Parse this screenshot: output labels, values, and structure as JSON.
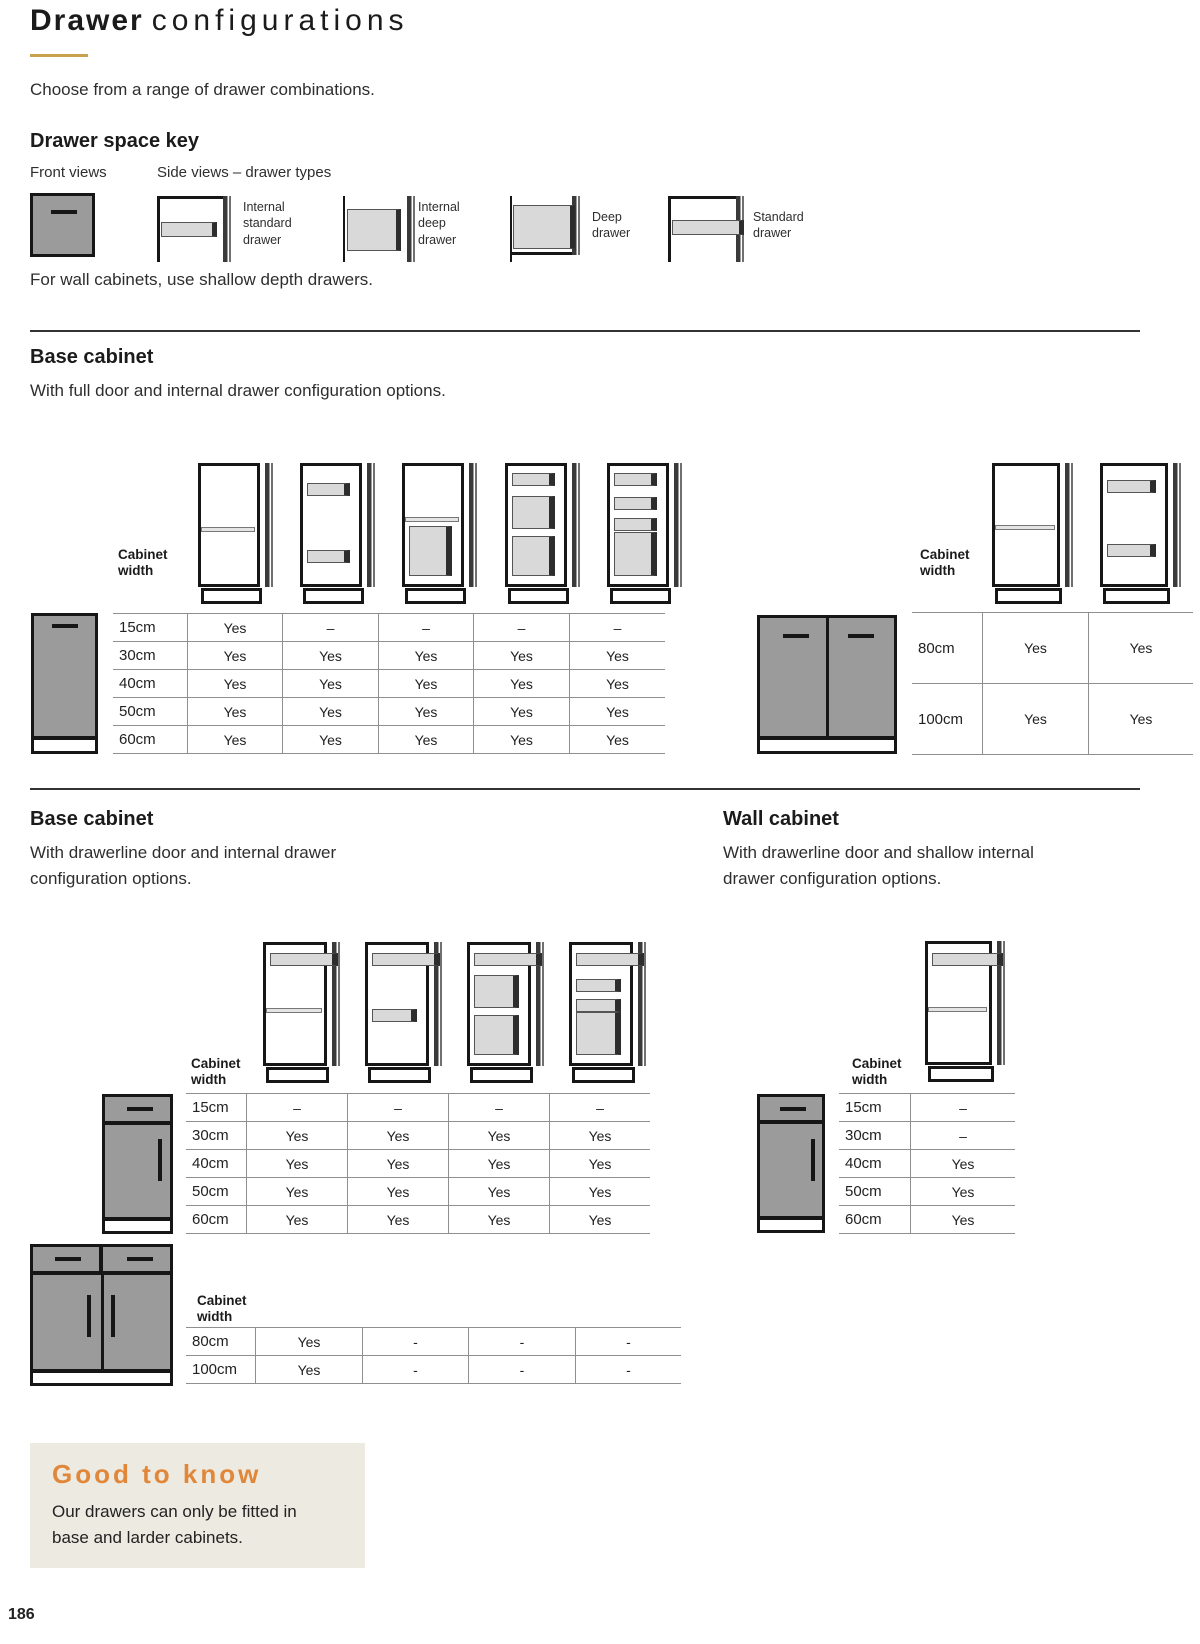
{
  "page_number": "186",
  "colors": {
    "accent_gold": "#c9a24f",
    "accent_orange": "#e0873a",
    "note_background": "#edeae1",
    "cabinet_gray": "#9b9b9b",
    "drawer_gray": "#d9d9d9"
  },
  "header": {
    "title_bold": "Drawer",
    "title_light": "configurations",
    "subtitle": "Choose from a range of drawer combinations."
  },
  "key": {
    "heading": "Drawer space key",
    "front_views_label": "Front views",
    "side_views_label": "Side views – drawer types",
    "types": [
      "Internal\nstandard\ndrawer",
      "Internal\ndeep\ndrawer",
      "Deep\ndrawer",
      "Standard\ndrawer"
    ],
    "note": "For wall cabinets, use shallow depth drawers."
  },
  "cabinet_width_label": "Cabinet\nwidth",
  "section_full_door": {
    "heading": "Base cabinet",
    "subheading": "With full door and internal drawer configuration options.",
    "table": {
      "rows": [
        {
          "label": "15cm",
          "values": [
            "Yes",
            "–",
            "–",
            "–",
            "–"
          ]
        },
        {
          "label": "30cm",
          "values": [
            "Yes",
            "Yes",
            "Yes",
            "Yes",
            "Yes"
          ]
        },
        {
          "label": "40cm",
          "values": [
            "Yes",
            "Yes",
            "Yes",
            "Yes",
            "Yes"
          ]
        },
        {
          "label": "50cm",
          "values": [
            "Yes",
            "Yes",
            "Yes",
            "Yes",
            "Yes"
          ]
        },
        {
          "label": "60cm",
          "values": [
            "Yes",
            "Yes",
            "Yes",
            "Yes",
            "Yes"
          ]
        }
      ]
    },
    "table_wide": {
      "rows": [
        {
          "label": "80cm",
          "values": [
            "Yes",
            "Yes"
          ]
        },
        {
          "label": "100cm",
          "values": [
            "Yes",
            "Yes"
          ]
        }
      ]
    }
  },
  "section_drawerline": {
    "heading": "Base cabinet",
    "subheading": "With drawerline door and internal drawer\nconfiguration options.",
    "table": {
      "rows": [
        {
          "label": "15cm",
          "values": [
            "–",
            "–",
            "–",
            "–"
          ]
        },
        {
          "label": "30cm",
          "values": [
            "Yes",
            "Yes",
            "Yes",
            "Yes"
          ]
        },
        {
          "label": "40cm",
          "values": [
            "Yes",
            "Yes",
            "Yes",
            "Yes"
          ]
        },
        {
          "label": "50cm",
          "values": [
            "Yes",
            "Yes",
            "Yes",
            "Yes"
          ]
        },
        {
          "label": "60cm",
          "values": [
            "Yes",
            "Yes",
            "Yes",
            "Yes"
          ]
        }
      ]
    },
    "table_wide": {
      "rows": [
        {
          "label": "80cm",
          "values": [
            "Yes",
            "-",
            "-",
            "-"
          ]
        },
        {
          "label": "100cm",
          "values": [
            "Yes",
            "-",
            "-",
            "-"
          ]
        }
      ]
    }
  },
  "section_wall": {
    "heading": "Wall cabinet",
    "subheading": "With drawerline door and shallow internal\ndrawer configuration options.",
    "table": {
      "rows": [
        {
          "label": "15cm",
          "values": [
            "–"
          ]
        },
        {
          "label": "30cm",
          "values": [
            "–"
          ]
        },
        {
          "label": "40cm",
          "values": [
            "Yes"
          ]
        },
        {
          "label": "50cm",
          "values": [
            "Yes"
          ]
        },
        {
          "label": "60cm",
          "values": [
            "Yes"
          ]
        }
      ]
    }
  },
  "good_to_know": {
    "heading": "Good to know",
    "body": "Our drawers can only be fitted in\nbase and larder cabinets."
  }
}
